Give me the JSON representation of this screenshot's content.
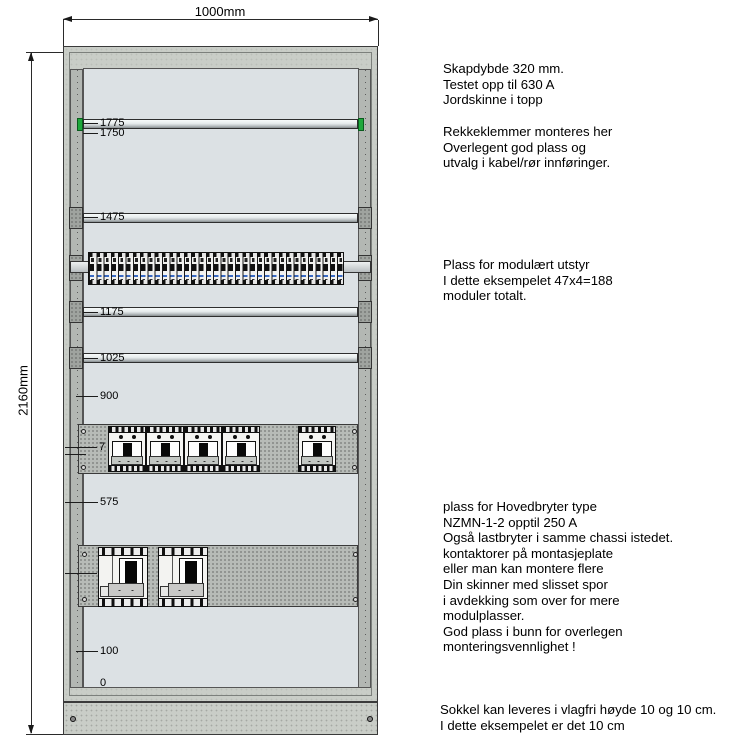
{
  "dimensions": {
    "width_label": "1000mm",
    "height_label": "2160mm"
  },
  "scale_labels": [
    {
      "text": "1775"
    },
    {
      "text": "1750"
    },
    {
      "text": "1475"
    },
    {
      "text": "1175"
    },
    {
      "text": "1025"
    },
    {
      "text": "900"
    },
    {
      "text": "7"
    },
    {
      "text": "575"
    },
    {
      "text": "100"
    },
    {
      "text": "0"
    }
  ],
  "annotations": {
    "block1": [
      "Skapdybde 320 mm.",
      "Testet opp til 630 A",
      "Jordskinne i topp"
    ],
    "block2": [
      "Rekkeklemmer monteres her",
      "Overlegent god plass og",
      "utvalg i kabel/rør innføringer."
    ],
    "block3": [
      "Plass for modulært utstyr",
      "I dette eksempelet 47x4=188",
      "moduler totalt."
    ],
    "block4": [
      "plass for Hovedbryter type",
      "NZMN-1-2 opptil 250 A",
      "Også lastbryter i samme chassi istedet.",
      "kontaktorer på montasjeplate",
      "eller man kan montere flere",
      "Din skinner med slisset spor",
      "i avdekking som over for mere",
      "modulplasser.",
      "God plass i bunn for overlegen",
      "monteringsvennlighet !"
    ],
    "block5": [
      "Sokkel kan leveres i vlagfri høyde 10 og 10 cm.",
      "I dette eksempelet er det 10 cm"
    ]
  },
  "counts": {
    "mccb_group": 4,
    "mccb_single": 1,
    "main_breakers": 2
  },
  "colors": {
    "frame": "#c9cdc7",
    "interior": "#dce1e4",
    "chassis": "#b7bbb7",
    "rail_green_cap": "#1ea83c",
    "module_blue": "#3a6bc4",
    "line": "#1c1c1c"
  }
}
